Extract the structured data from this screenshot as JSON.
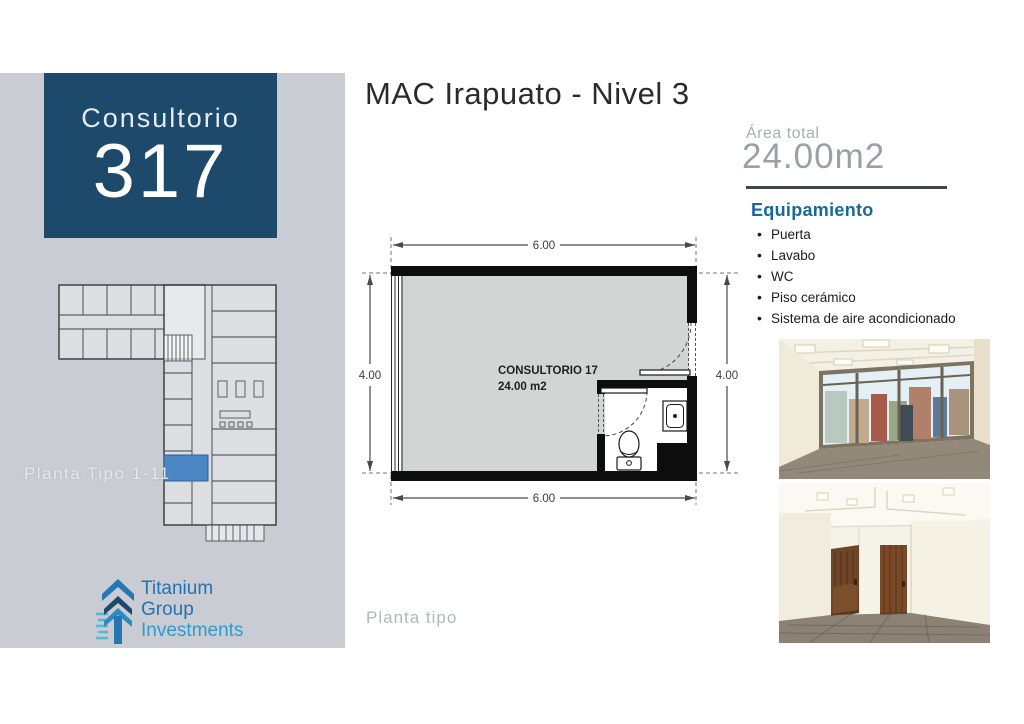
{
  "sidebar": {
    "unit_label": "Consultorio",
    "unit_number": "317",
    "plan_caption": "Planta Tipo 1-11",
    "logo": {
      "lines": [
        "Titanium",
        "Group",
        "Investments"
      ]
    }
  },
  "header": {
    "title": "MAC Irapuato - Nivel 3"
  },
  "plan": {
    "room_name": "CONSULTORIO 17",
    "room_area": "24.00 m2",
    "dim_top": "6.00",
    "dim_bottom": "6.00",
    "dim_left": "4.00",
    "dim_right": "4.00",
    "caption": "Planta tipo"
  },
  "details": {
    "area_label": "Área total",
    "area_value": "24.00m2",
    "equipment_title": "Equipamiento",
    "equipment_items": [
      "Puerta",
      "Lavabo",
      "WC",
      "Piso cerámico",
      "Sistema de aire acondicionado"
    ]
  },
  "photos": {
    "photo1_name": "office-window-render",
    "photo2_name": "office-doors-render"
  },
  "colors": {
    "navy": "#1d4a6b",
    "accent_blue": "#19689b",
    "sidebar_gray": "#c9ccd2",
    "highlight_room": "#4d86c5"
  }
}
